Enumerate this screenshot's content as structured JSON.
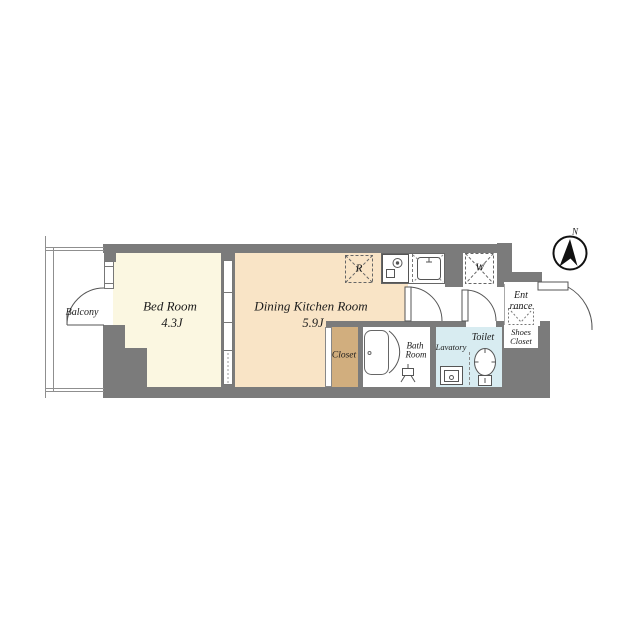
{
  "compass": {
    "north_label": "N"
  },
  "balcony": {
    "label": "Balcony"
  },
  "bedroom": {
    "label": "Bed Room",
    "area": "4.3J"
  },
  "dining_kitchen": {
    "label": "Dining Kitchen Room",
    "area": "5.9J"
  },
  "closet": {
    "label": "Closet"
  },
  "bath": {
    "label_line1": "Bath",
    "label_line2": "Room"
  },
  "lavatory": {
    "label": "Lavatory"
  },
  "toilet": {
    "label": "Toilet"
  },
  "entrance": {
    "label_line1": "Ent",
    "label_line2": "rance"
  },
  "shoes_closet": {
    "label_line1": "Shoes",
    "label_line2": "Closet"
  },
  "appliances": {
    "refrigerator_label": "R",
    "washer_label": "W"
  },
  "colors": {
    "wall": "#7b7b7b",
    "bedroom_floor": "#fbf7e1",
    "dining_kitchen_floor": "#f9e4c6",
    "closet_floor": "#d1ae7e",
    "wet_area_floor": "#d8ecf1"
  }
}
